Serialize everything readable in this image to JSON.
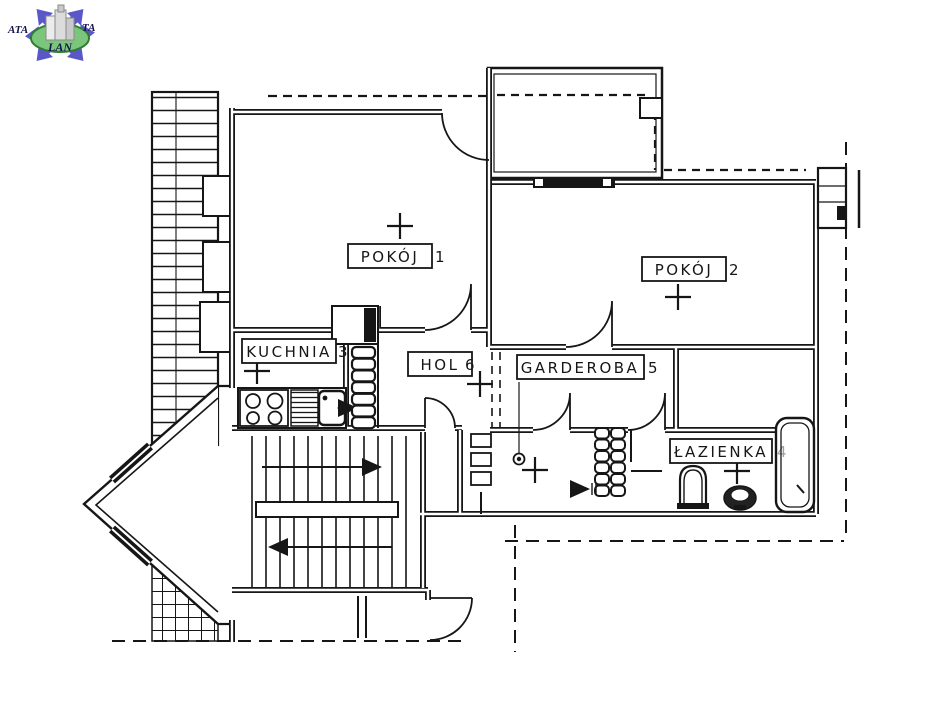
{
  "page": {
    "background": "#ffffff"
  },
  "logo": {
    "text_left": "ATA",
    "text_right": "TA",
    "text_bottom": "LAN",
    "arrow_color": "#5b57c9",
    "globe_fill": "#7cc67c",
    "globe_stroke": "#2e7d32",
    "building_color": "#d9d9d9",
    "text_color": "#14144d"
  },
  "plan": {
    "line_color": "#161616",
    "labels": {
      "pokoj1": {
        "label": "POKÓJ",
        "number": "1"
      },
      "pokoj2": {
        "label": "POKÓJ",
        "number": "2"
      },
      "kuchnia": {
        "label": "KUCHNIA",
        "number": "3"
      },
      "lazienka": {
        "label": "ŁAZIENKA",
        "number": "4"
      },
      "garderoba": {
        "label": "GARDEROBA",
        "number": "5"
      },
      "hol": {
        "label": "HOL",
        "number": "6"
      }
    }
  }
}
